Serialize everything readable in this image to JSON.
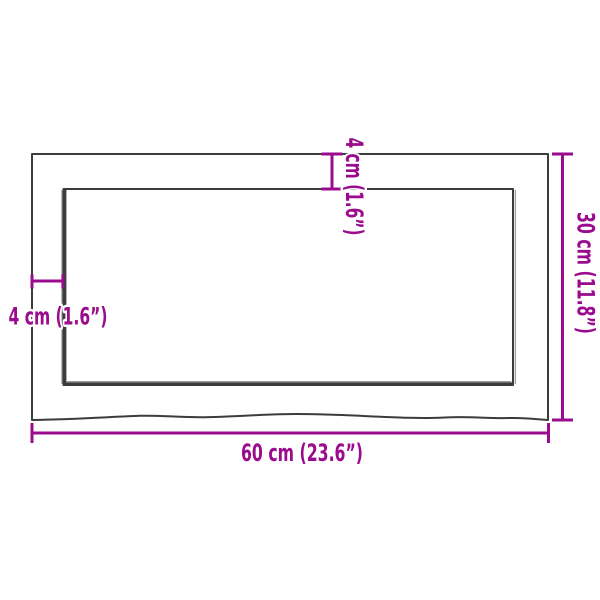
{
  "diagram": {
    "type": "product-dimension-diagram",
    "subject": "rectangular board with live edge, top view",
    "colors": {
      "background": "#ffffff",
      "outline": "#3c3c3c",
      "accent": "#9a0b8d"
    },
    "dimensions": [
      {
        "id": "width",
        "label": "60 cm (23.6”)",
        "cm": 60,
        "inches": 23.6
      },
      {
        "id": "height",
        "label": "30 cm (11.8”)",
        "cm": 30,
        "inches": 11.8
      },
      {
        "id": "top-thickness",
        "label": "4 cm (1.6”)",
        "cm": 4,
        "inches": 1.6
      },
      {
        "id": "left-thickness",
        "label": "4 cm (1.6”)",
        "cm": 4,
        "inches": 1.6
      }
    ]
  }
}
